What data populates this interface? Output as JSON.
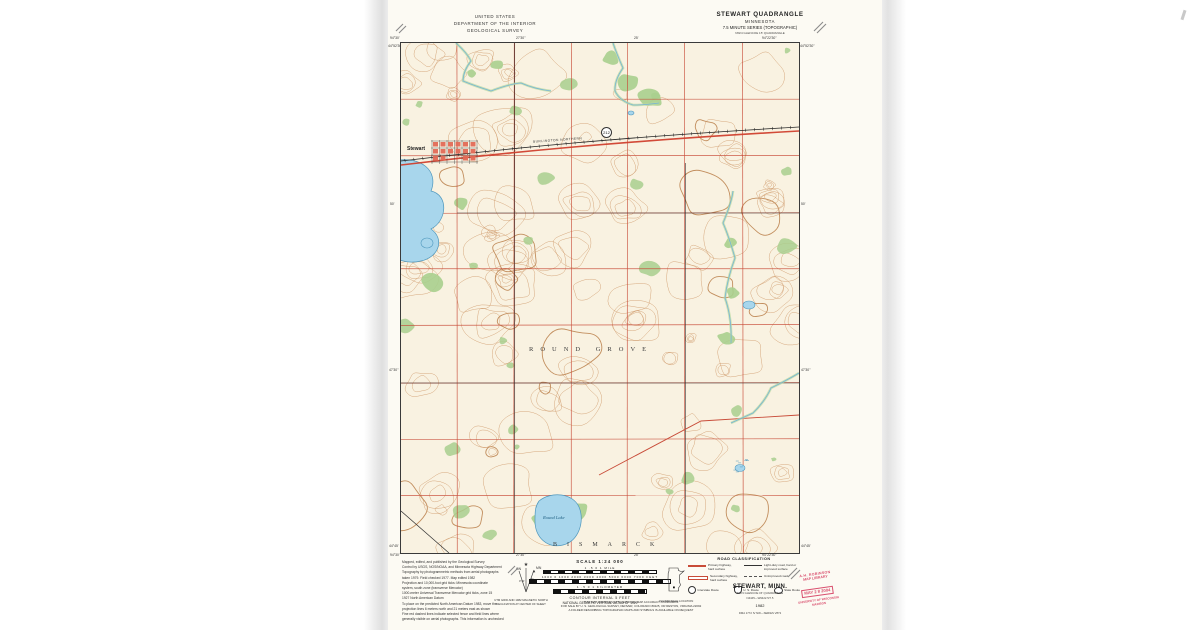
{
  "header": {
    "us": "UNITED STATES",
    "dept": "DEPARTMENT OF THE INTERIOR",
    "survey": "GEOLOGICAL SURVEY",
    "quad_title": "STEWART QUADRANGLE",
    "state": "MINNESOTA",
    "series": "7.5 MINUTE SERIES (TOPOGRAPHIC)",
    "series_sub": "NW/4 GLENCOE 15' QUADRANGLE"
  },
  "edges": {
    "top": [
      "94°30'",
      "27'30\"",
      "25'",
      "94°22'30\""
    ],
    "bottom": [
      "94°30'",
      "27'30\"",
      "25'",
      "94°22'30\""
    ],
    "left": [
      "44°52'30\"",
      "50'",
      "47'30\"",
      "44°45'"
    ],
    "right": [
      "44°52'30\"",
      "50'",
      "47'30\"",
      "44°45'"
    ]
  },
  "map_labels": {
    "township_center": "ROUND GROVE",
    "township_south": "BISMARCK",
    "town": "Stewart",
    "lake_south": "Round Lake",
    "railroad": "BURLINGTON NORTHERN",
    "route_shield": "212"
  },
  "credits": {
    "lines": [
      "Mapped, edited, and published by the Geological Survey",
      "Control by USGS, NOS/NOAA, and Minnesota Highway Department",
      "Topography by photogrammetric methods from aerial photographs",
      "taken 1979.  Field checked 1977.  Map edited 1982",
      "Projection and 10,000-foot grid ticks: Minnesota coordinate",
      "system, south zone (transverse Mercator)",
      "1000-meter Universal Transverse Mercator grid ticks, zone 15",
      "1927 North American Datum",
      "To place on the predicted North American Datum 1983, move the",
      "projection lines 6 meters north and 21 meters east as shown",
      "Fine red dashed lines indicate selected fence and field lines where",
      "generally visible on aerial photographs. This information is unchecked"
    ]
  },
  "declination": {
    "gn": "GN",
    "mn": "MN",
    "gn_angle": "0°41'",
    "mn_angle": "5°",
    "cap1": "UTM GRID AND 1982 MAGNETIC NORTH",
    "cap2": "DECLINATION AT CENTER OF SHEET"
  },
  "scalebar": {
    "title": "SCALE 1:24 000",
    "miles_labels": "1   .5   0   1 MILE",
    "feet_labels": "1000  0  1000  2000  3000  4000  5000  6000  7000 FEET",
    "km_labels": "1   .5   0   1 KILOMETER",
    "contour": "CONTOUR INTERVAL 5 FEET",
    "datum": "NATIONAL GEODETIC VERTICAL DATUM OF 1929"
  },
  "notes": {
    "accuracy": "THIS MAP COMPLIES WITH NATIONAL MAP ACCURACY STANDARDS",
    "sale": "FOR SALE BY U. S. GEOLOGICAL SURVEY, DENVER, COLORADO 80225, OR RESTON, VIRGINIA 22092",
    "folder": "A FOLDER DESCRIBING TOPOGRAPHIC MAPS AND SYMBOLS IS AVAILABLE ON REQUEST"
  },
  "quad_location": {
    "caption": "QUADRANGLE LOCATION"
  },
  "road_class": {
    "title": "ROAD CLASSIFICATION",
    "primary1": "Primary highway,",
    "primary2": "hard surface",
    "secondary1": "Secondary highway,",
    "secondary2": "hard surface",
    "light1": "Light-duty road, hard or",
    "light2": "improved surface",
    "unimproved": "Unimproved road",
    "interstate": "Interstate Route",
    "us_route": "U. S. Route",
    "state_route": "State Route"
  },
  "sheet_title": {
    "name": "STEWART, MINN.",
    "sub1": "NW/4 GLENCOE 15' QUADRANGLE",
    "sub2": "N4445—W9422.5/7.5",
    "year": "1982",
    "series_no": "DMA 1772 IV NW—SERIES V872"
  },
  "stamp": {
    "l1": "A.H. ROBINSON",
    "l2": "MAP LIBRARY",
    "date": "MAY 2 8 2004",
    "l3": "UNIVERSITY OF WISCONSIN",
    "l4": "MADISON"
  },
  "colors": {
    "contour": "#cf9a6b",
    "index_contour": "#b97c47",
    "section_line_red": "#c84b38",
    "water_fill": "#a8d6ec",
    "water_edge": "#4e97bd",
    "vegetation": "#a9cf8e",
    "town_red": "#e26a56",
    "stamp_red": "#d94f6e",
    "paper": "#f9f2e1"
  }
}
